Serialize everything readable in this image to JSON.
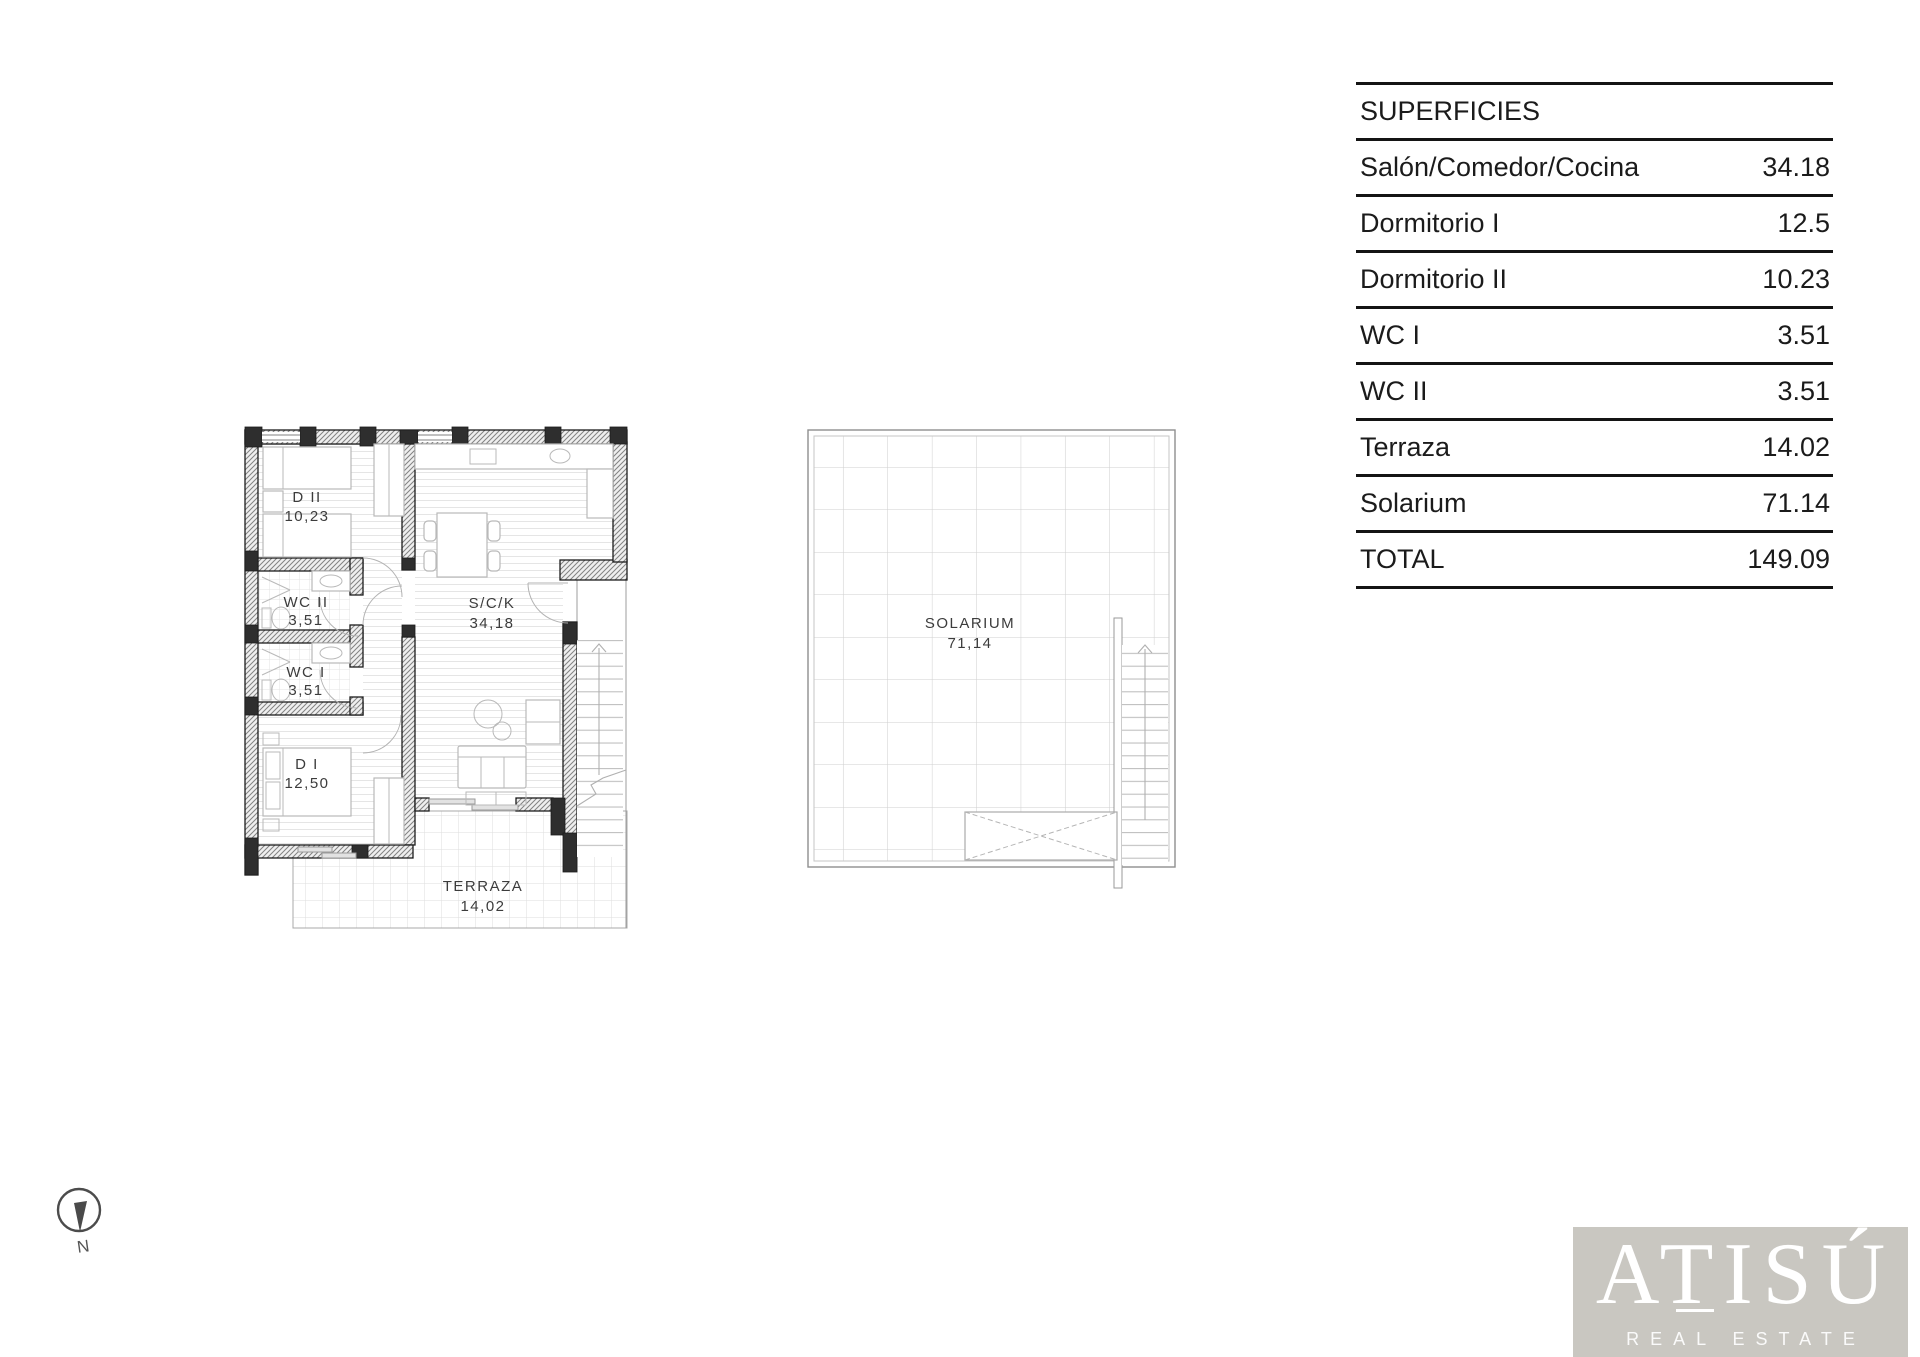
{
  "surfaces_table": {
    "title": "SUPERFICIES",
    "rows": [
      {
        "label": "Salón/Comedor/Cocina",
        "value": "34.18"
      },
      {
        "label": "Dormitorio I",
        "value": "12.5"
      },
      {
        "label": "Dormitorio II",
        "value": "10.23"
      },
      {
        "label": "WC I",
        "value": "3.51"
      },
      {
        "label": "WC II",
        "value": "3.51"
      },
      {
        "label": "Terraza",
        "value": "14.02"
      },
      {
        "label": "Solarium",
        "value": "71.14"
      },
      {
        "label": "TOTAL",
        "value": "149.09"
      }
    ]
  },
  "apartment_plan": {
    "rooms": [
      {
        "name": "D II",
        "area": "10,23"
      },
      {
        "name": "WC II",
        "area": "3,51"
      },
      {
        "name": "WC I",
        "area": "3,51"
      },
      {
        "name": "D I",
        "area": "12,50"
      },
      {
        "name": "S/C/K",
        "area": "34,18"
      },
      {
        "name": "TERRAZA",
        "area": "14,02"
      }
    ]
  },
  "solarium_plan": {
    "name": "SOLARIUM",
    "area": "71,14"
  },
  "compass": {
    "label": "N"
  },
  "logo": {
    "brand": "ATISÚ",
    "tagline": "REAL ESTATE",
    "background": "#c9c7c1",
    "text_color": "#ffffff"
  }
}
